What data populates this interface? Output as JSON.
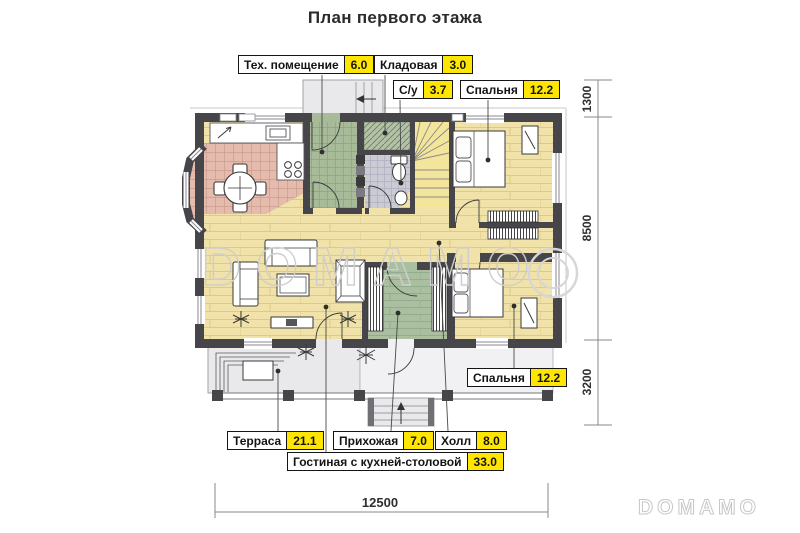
{
  "title": "План первого этажа",
  "watermark": {
    "center": "DOMAMO",
    "corner": "DOMAMO"
  },
  "rooms": [
    {
      "id": "tech",
      "label": "Тех. помещение",
      "area": "6.0"
    },
    {
      "id": "storage",
      "label": "Кладовая",
      "area": "3.0"
    },
    {
      "id": "bathroom",
      "label": "С/у",
      "area": "3.7"
    },
    {
      "id": "bedroom_top",
      "label": "Спальня",
      "area": "12.2"
    },
    {
      "id": "bedroom_bottom",
      "label": "Спальня",
      "area": "12.2"
    },
    {
      "id": "terrace",
      "label": "Терраса",
      "area": "21.1"
    },
    {
      "id": "hallway",
      "label": "Прихожая",
      "area": "7.0"
    },
    {
      "id": "hall",
      "label": "Холл",
      "area": "8.0"
    },
    {
      "id": "living",
      "label": "Гостиная с кухней-столовой",
      "area": "33.0"
    }
  ],
  "dimensions": {
    "right_top": "1300",
    "right_middle": "8500",
    "right_bottom": "3200",
    "bottom_width": "12500"
  },
  "colors": {
    "area_highlight": "#FFE600",
    "wall": "#46464A",
    "wood_floor": "#F0E2A8",
    "kitchen_tile": "#E5BBAD",
    "tech_tile": "#A7BB98",
    "bath_tile": "#CBCBD6",
    "hall_green": "#AABF9F",
    "stairs": "#F4E59C",
    "terrace": "#E9E9EC",
    "watermark": "#CECECE"
  }
}
